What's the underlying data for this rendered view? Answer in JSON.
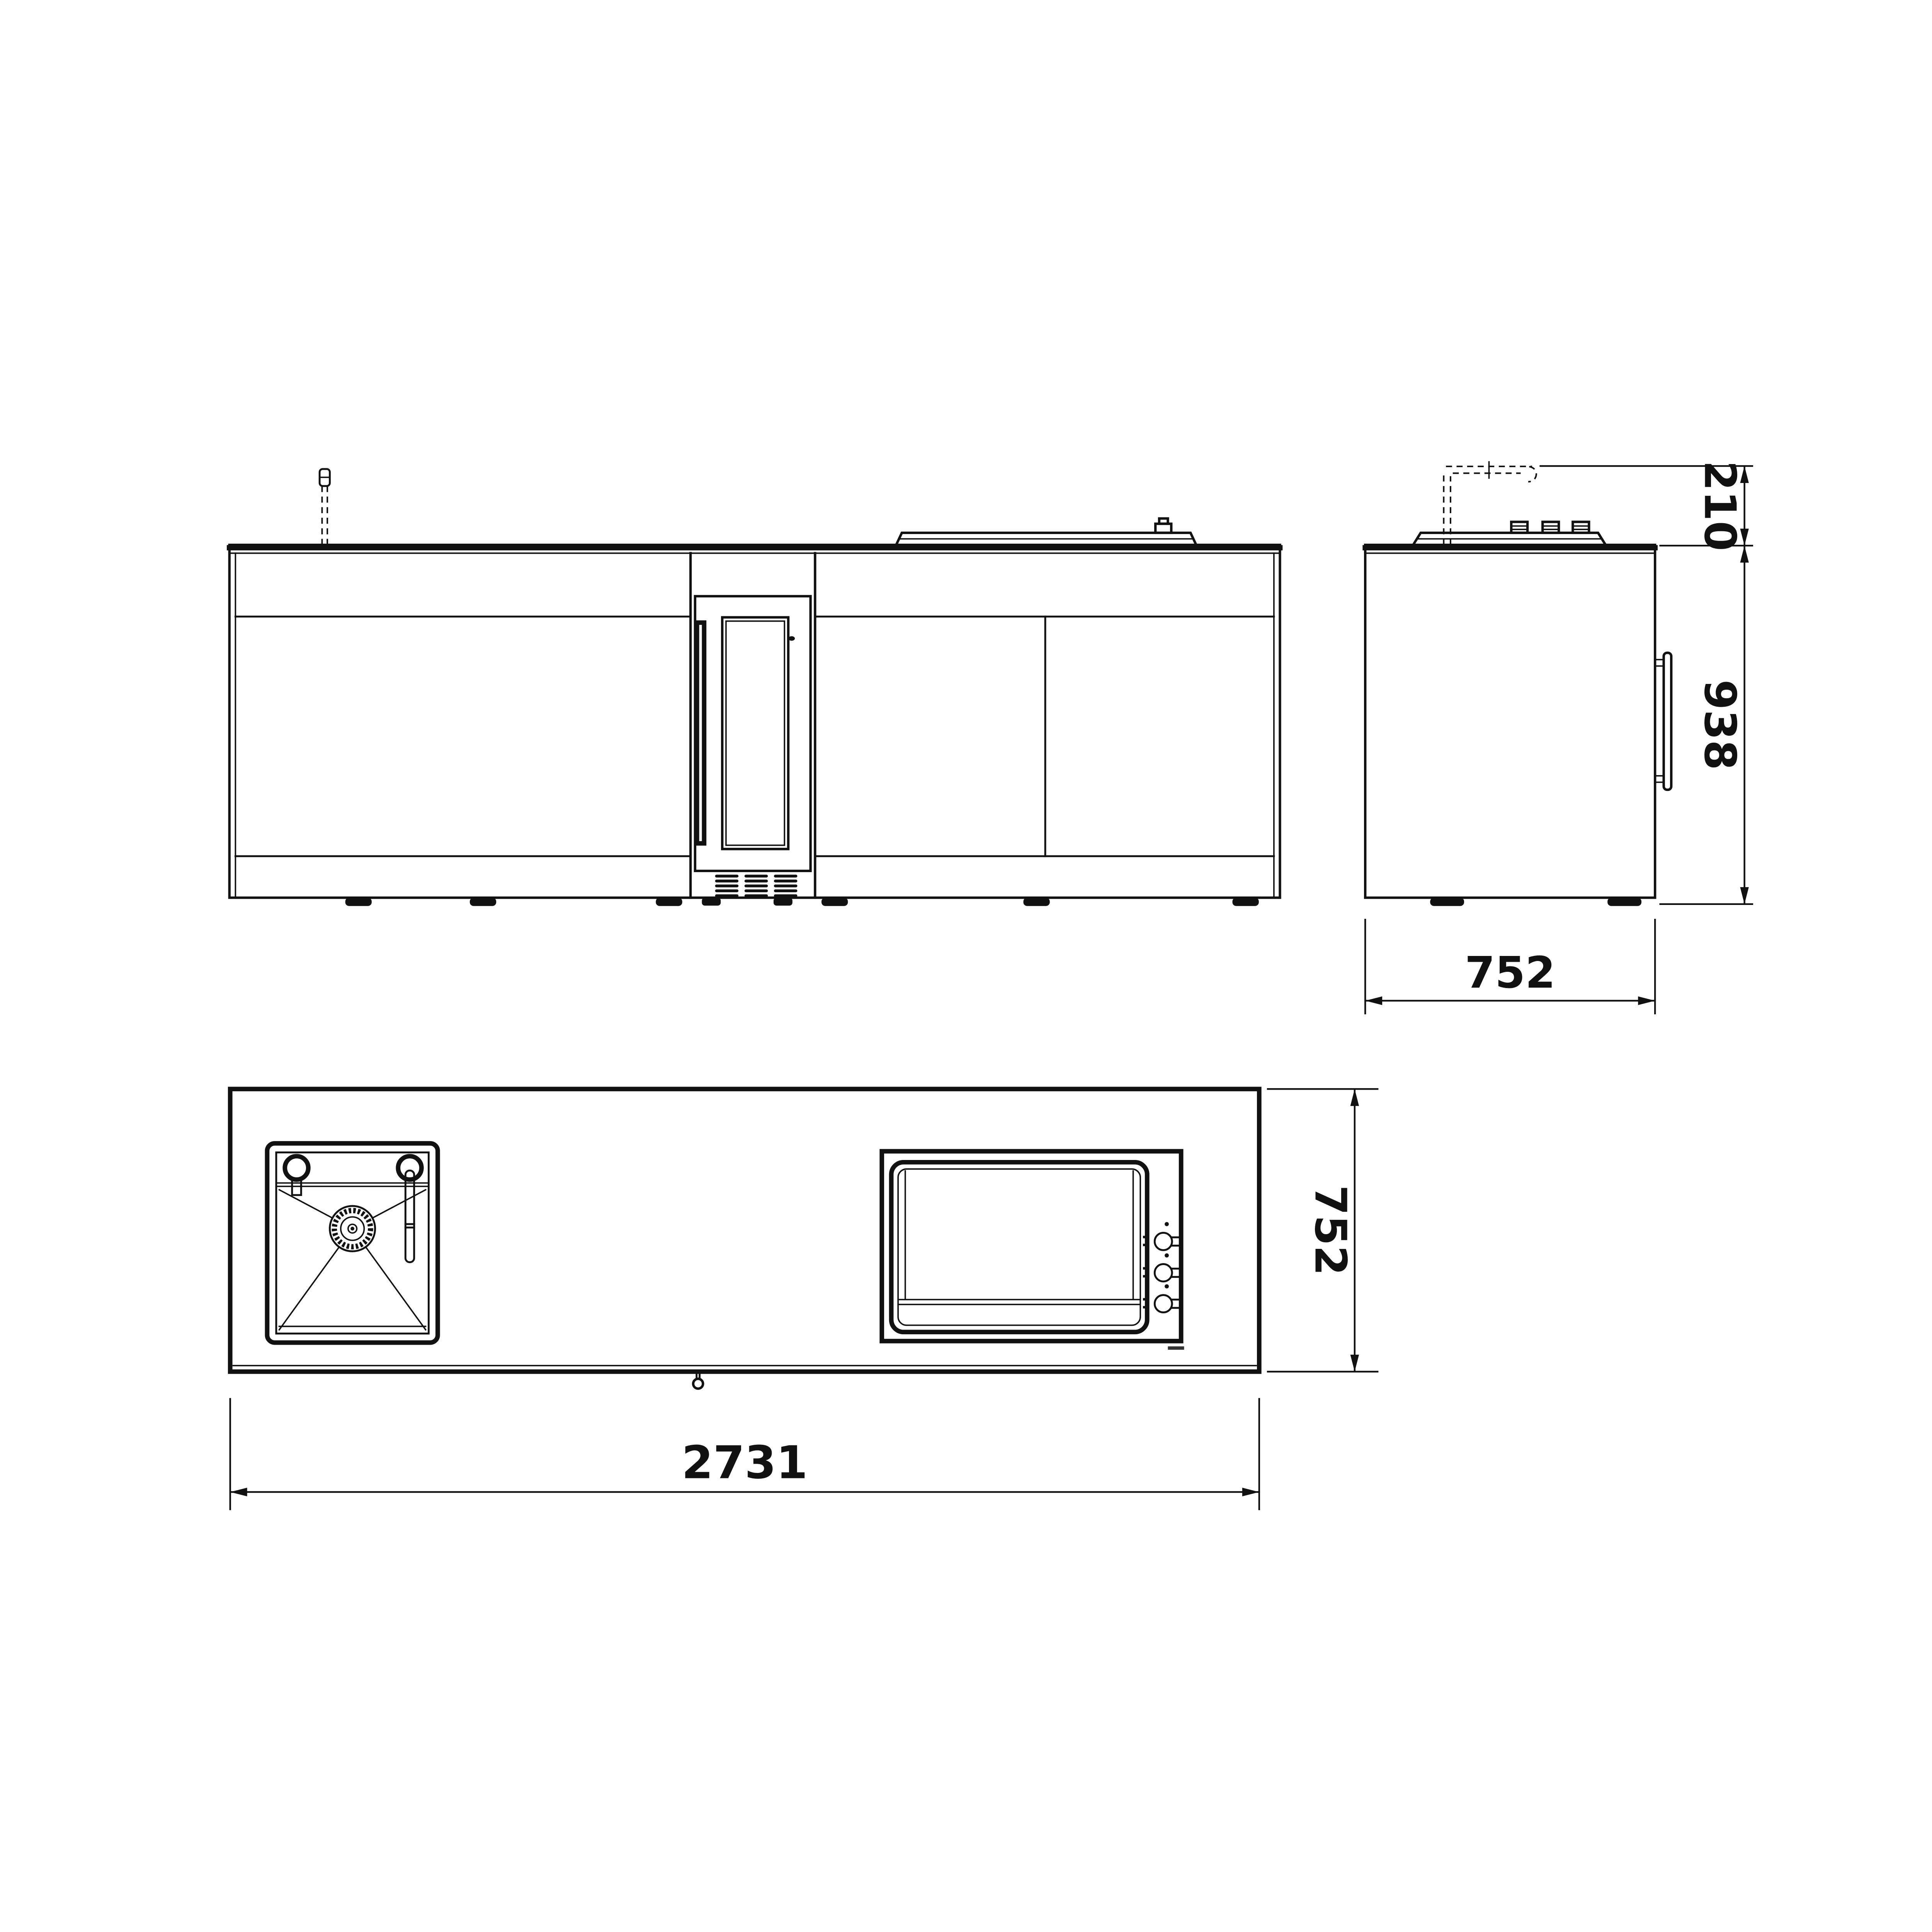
{
  "colors": {
    "background": "#ffffff",
    "line": "#111111"
  },
  "dimensions": {
    "upper_height": "210",
    "body_height": "938",
    "side_depth": "752",
    "plan_depth": "752",
    "overall_width": "2731"
  }
}
